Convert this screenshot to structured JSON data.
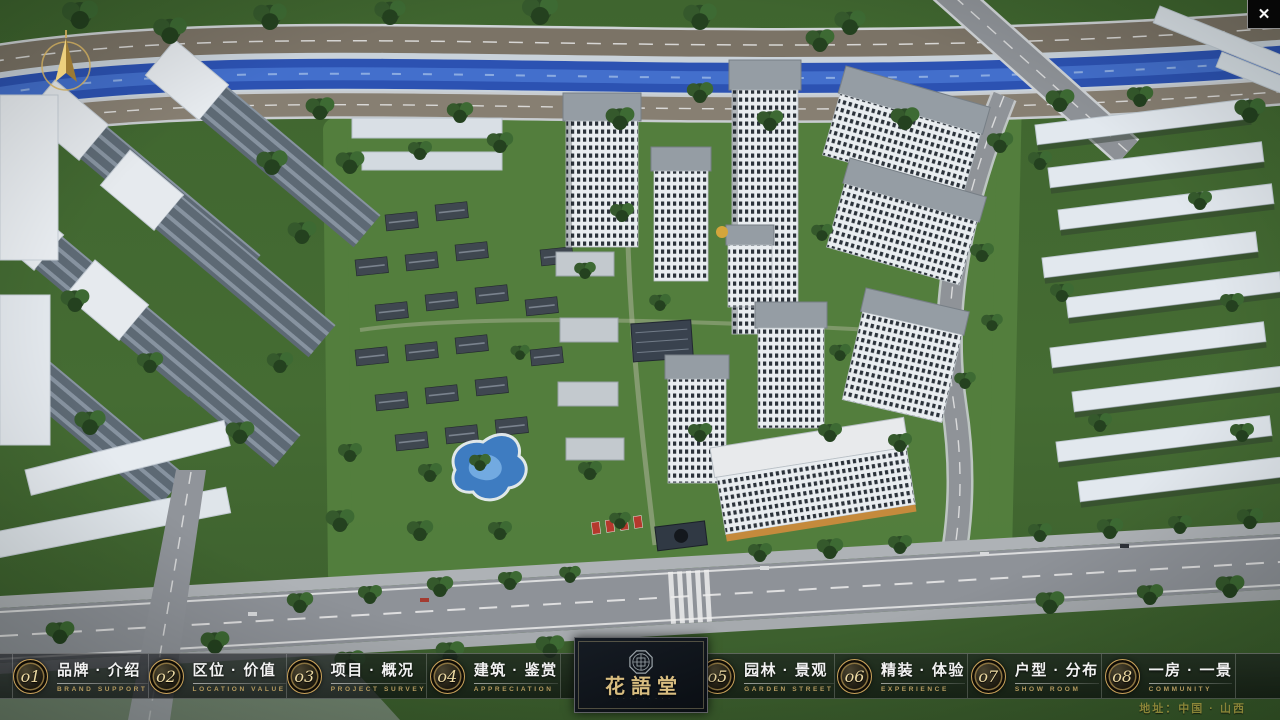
{
  "nav": {
    "items": [
      {
        "num": "o1",
        "label": "品牌 · 介绍",
        "sublabel": "BRAND SUPPORT"
      },
      {
        "num": "o2",
        "label": "区位 · 价值",
        "sublabel": "LOCATION VALUE"
      },
      {
        "num": "o3",
        "label": "项目 · 概况",
        "sublabel": "PROJECT SURVEY"
      },
      {
        "num": "o4",
        "label": "建筑 · 鉴赏",
        "sublabel": "APPRECIATION"
      },
      {
        "num": "o5",
        "label": "园林 · 景观",
        "sublabel": "GARDEN STREET"
      },
      {
        "num": "o6",
        "label": "精装 · 体验",
        "sublabel": "EXPERIENCE"
      },
      {
        "num": "o7",
        "label": "户型 · 分布",
        "sublabel": "SHOW ROOM"
      },
      {
        "num": "o8",
        "label": "一房 · 一景",
        "sublabel": "COMMUNITY"
      }
    ]
  },
  "logo": {
    "title": "花語堂",
    "subtitle": "· · · · · · · · · ·"
  },
  "footer": {
    "address": "地址：中国 · 山西"
  },
  "window_controls": {
    "close_glyph": "✕"
  },
  "icons": {
    "compass": "compass-north-needle",
    "seal": "octagonal-brand-seal",
    "close": "x-mark"
  },
  "colors": {
    "gold_accent": "#c9a85c",
    "nav_text": "#f2f2f2",
    "nav_sublabel": "#b49a5e",
    "logo_gold": "#d8bd80",
    "bar_background": "rgba(10,12,15,0.62)",
    "river_blue": "#2c52b2"
  }
}
